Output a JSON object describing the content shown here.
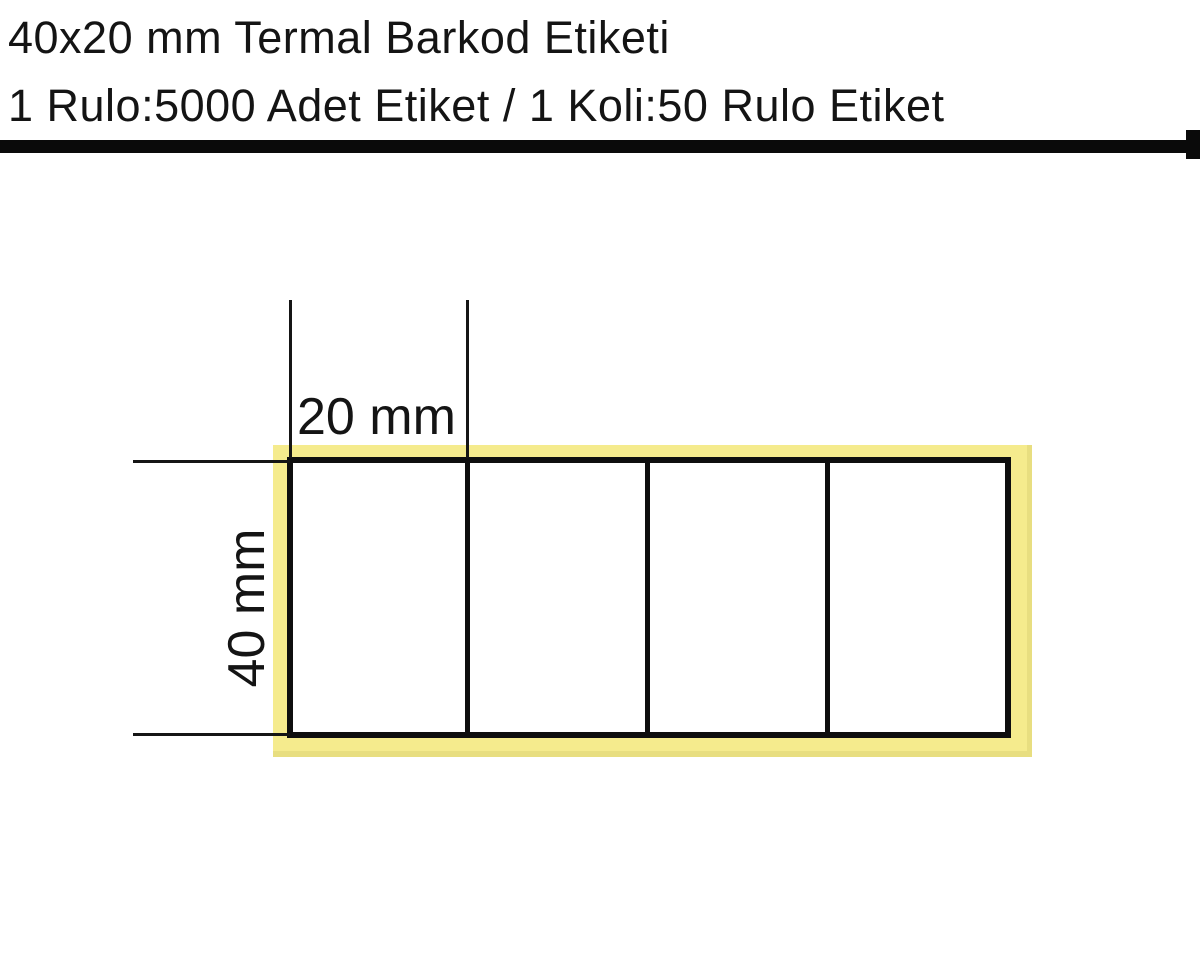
{
  "page": {
    "background": "#FFFFFF"
  },
  "header": {
    "title": "40x20 mm Termal Barkod Etiketi",
    "subtitle": "1 Rulo:5000 Adet Etiket / 1 Koli:50 Rulo Etiket"
  },
  "diagram": {
    "dimension_width_label": "20 mm",
    "dimension_height_label": "40 mm",
    "labels_per_row": 4,
    "colors": {
      "liner_yellow": "#F5EB8D",
      "label_white": "#FFFFFF",
      "line_black": "#0E0E0E"
    }
  }
}
